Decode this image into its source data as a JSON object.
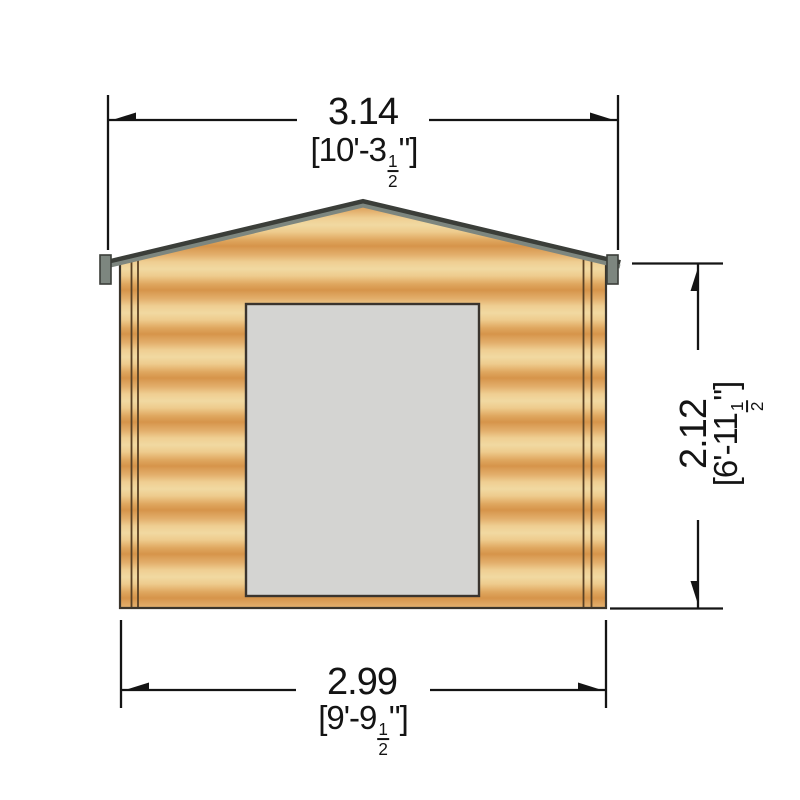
{
  "drawing": {
    "view": "shed front elevation",
    "colors": {
      "background": "#ffffff",
      "wood_light": "#f1d9a1",
      "wood_mid": "#e3b06d",
      "wood_dark": "#d6944a",
      "roof_trim": "#7d867f",
      "roof_trim_dark": "#3b3e39",
      "door_fill": "#d4d4d2",
      "door_border": "#3a342e",
      "wall_outline": "#3b352c",
      "dimension_line": "#141414"
    },
    "dimensions": {
      "top_width": {
        "metric": "3.14",
        "imperial_prefix": "[10'-3",
        "fraction_numerator": "1",
        "fraction_denominator": "2",
        "imperial_suffix": "\"]"
      },
      "base_width": {
        "metric": "2.99",
        "imperial_prefix": "[9'-9",
        "fraction_numerator": "1",
        "fraction_denominator": "2",
        "imperial_suffix": "\"]"
      },
      "height": {
        "metric": "2.12",
        "imperial_prefix": "[6'-11",
        "fraction_numerator": "1",
        "fraction_denominator": "2",
        "imperial_suffix": "\"]"
      }
    }
  }
}
